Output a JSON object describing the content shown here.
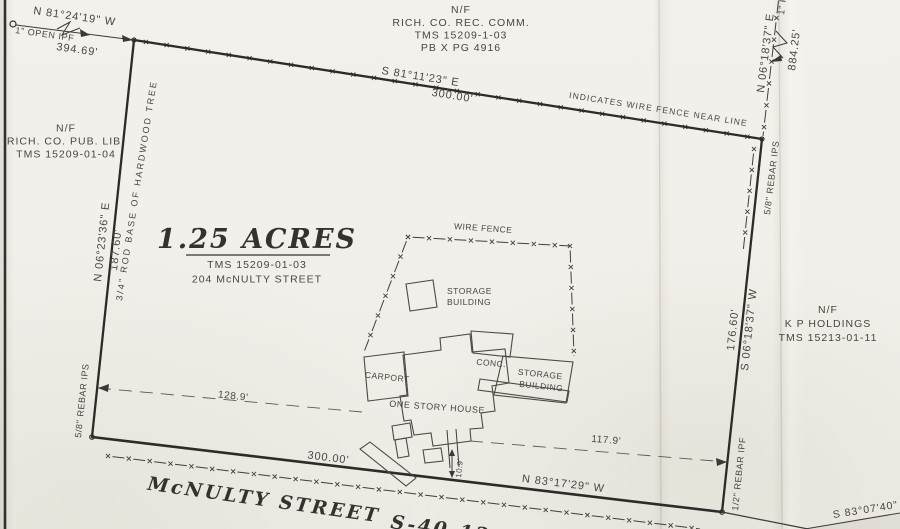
{
  "parcel": {
    "acres": "1.25 ACRES",
    "tms": "TMS 15209-01-03",
    "address": "204 McNULTY STREET"
  },
  "adjoiner_north": {
    "nf": "N/F",
    "line1": "RICH. CO. REC. COMM.",
    "line2": "TMS 15209-1-03",
    "line3": "PB X PG 4916"
  },
  "adjoiner_west": {
    "nf": "N/F",
    "line1": "RICH. CO. PUB. LIB.",
    "line2": "TMS 15209-01-04"
  },
  "adjoiner_east": {
    "nf": "N/F",
    "line1": "K P HOLDINGS",
    "line2": "TMS 15213-01-11"
  },
  "north_line": {
    "bearing": "S 81°11'23\" E",
    "distance": "300.00'",
    "fence_note": "INDICATES WIRE FENCE NEAR LINE"
  },
  "west_line": {
    "bearing": "N 06°23'36\" E",
    "distance": "187.60'",
    "nw_corner_monument": "3/4\" ROD BASE OF HARDWOOD TREE",
    "sw_monument": "5/8\" REBAR IPS"
  },
  "east_line": {
    "bearing": "S 06°18'37\" W",
    "distance": "176.60'",
    "ne_monument": "5/8\" REBAR IPS",
    "se_monument": "1/2\" REBAR IPF"
  },
  "south_line": {
    "bearing": "N 83°17'29\" W",
    "distance": "300.00'"
  },
  "tie_nw": {
    "bearing": "N 81°24'19\" W",
    "distance": "394.69'",
    "monument": "1\" OPEN IPF"
  },
  "tie_ne": {
    "bearing": "N 06°18'37\" E",
    "distance": "884.25'",
    "monument": "1\" P"
  },
  "street": {
    "name": "McNULTY STREET",
    "route": "S-40-12",
    "next_bearing": "S 83°07'40\""
  },
  "features": {
    "wire_fence": "WIRE FENCE",
    "storage_small_1": "STORAGE",
    "storage_small_2": "BUILDING",
    "storage_large_1": "STORAGE",
    "storage_large_2": "BUILDING",
    "carport": "CARPORT",
    "conc": "CONC.",
    "house": "ONE STORY HOUSE"
  },
  "dims": {
    "west_to_house": "128.9'",
    "house_to_east": "117.9'",
    "walk": "10.9'"
  }
}
